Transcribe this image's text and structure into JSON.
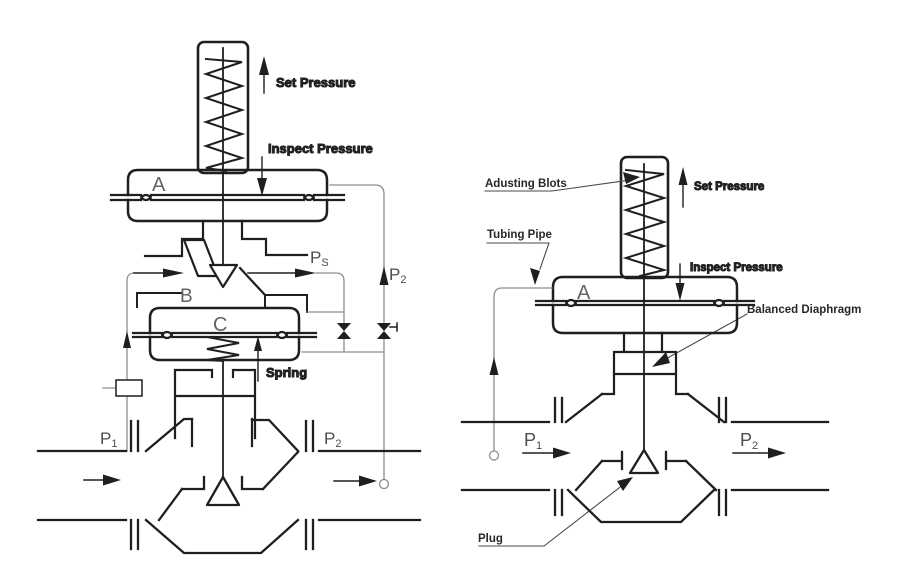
{
  "figure": {
    "background": "#ffffff",
    "line_color": "#1f1f1f",
    "pipe_line_color": "#8d8d8d",
    "leader_color": "#4a4a4a",
    "label_color": "#272727",
    "port_label_color": "#4c4c4c",
    "chamber_label_color": "#636363"
  },
  "left_diagram": {
    "labels": {
      "set_pressure": "Set Pressure",
      "inspect_pressure": "Inspect Pressure",
      "chamber_a": "A",
      "chamber_b": "B",
      "chamber_c": "C",
      "spring": "Spring",
      "pilot_pressure": {
        "main": "P",
        "sub": "S"
      },
      "sense_p2": {
        "main": "P",
        "sub": "2"
      },
      "port_p1": {
        "main": "P",
        "sub": "1"
      },
      "port_p2": {
        "main": "P",
        "sub": "2"
      }
    }
  },
  "right_diagram": {
    "labels": {
      "adjusting_bolts": "Adusting Blots",
      "set_pressure": "Set Pressure",
      "tubing_pipe": "Tubing Pipe",
      "inspect_pressure": "Inspect Pressure",
      "chamber_a": "A",
      "balanced_diaphragm": "Balanced Diaphragm",
      "plug": "Plug",
      "port_p1": {
        "main": "P",
        "sub": "1"
      },
      "port_p2": {
        "main": "P",
        "sub": "2"
      }
    }
  }
}
